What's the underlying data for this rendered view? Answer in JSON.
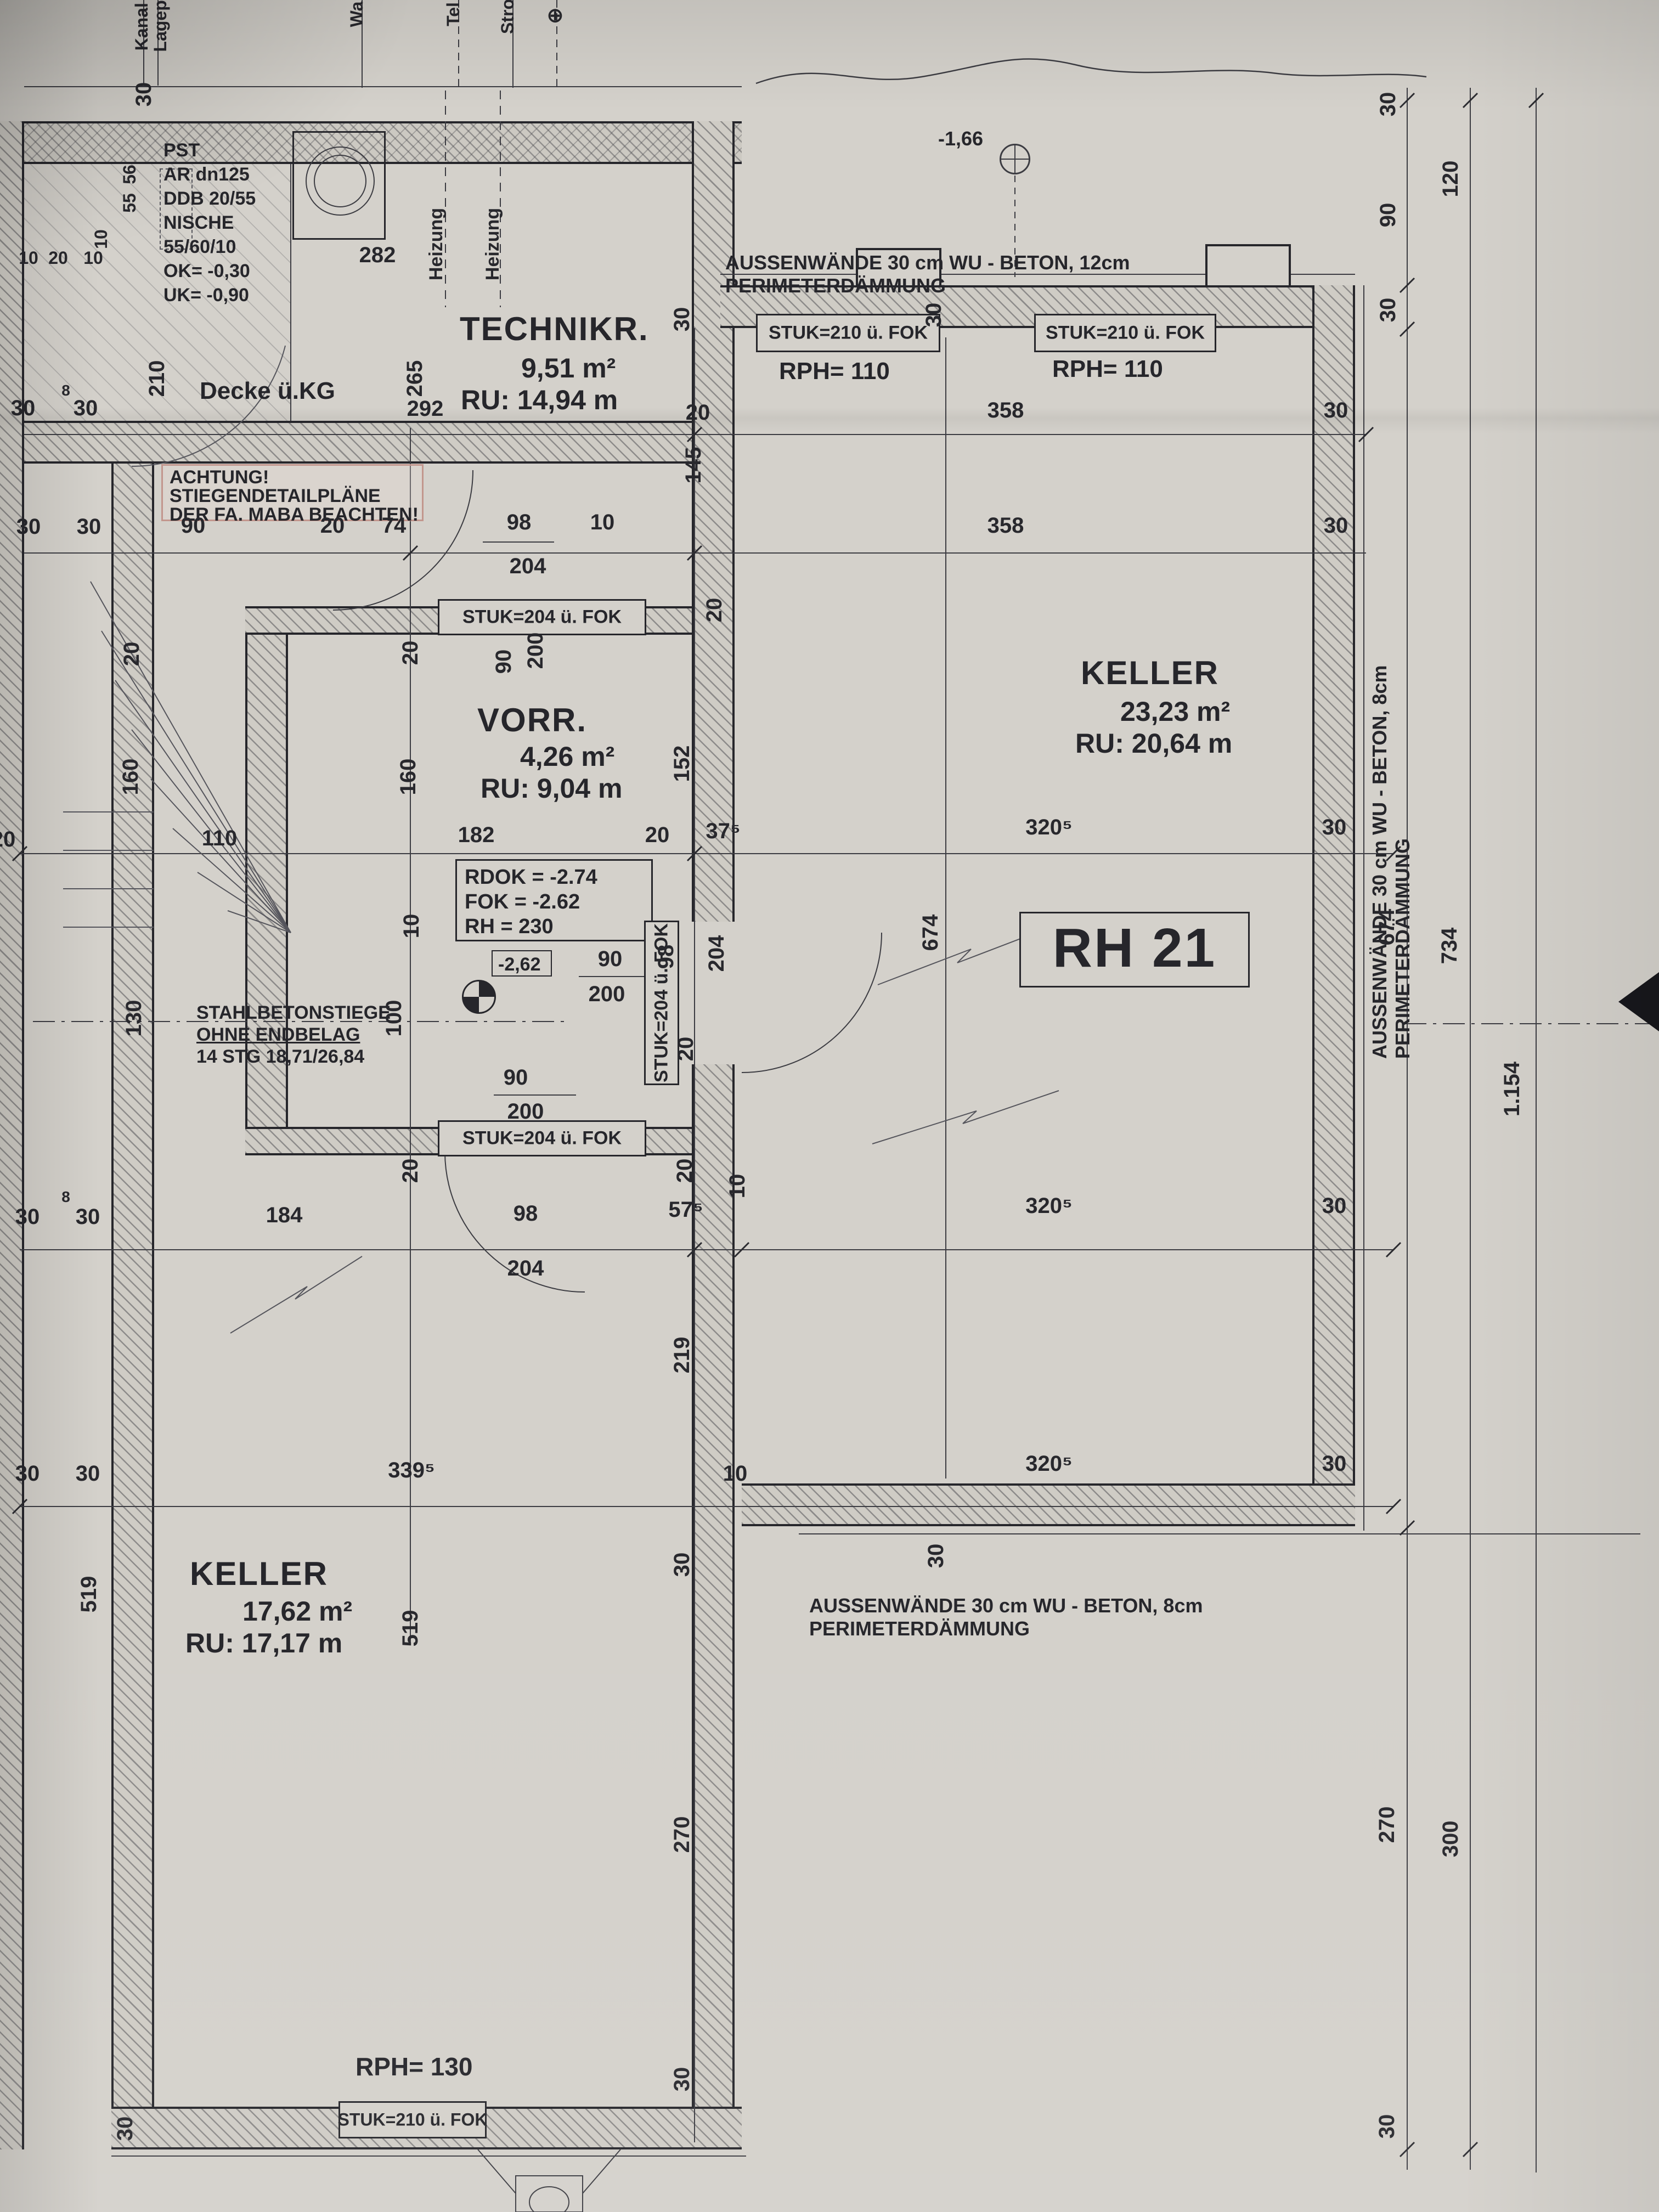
{
  "unit": {
    "label": "RH 21"
  },
  "rooms": {
    "technikraum": {
      "name": "TECHNIKR.",
      "area": "9,51 m²",
      "ru": "RU: 14,94 m"
    },
    "vorraum": {
      "name": "VORR.",
      "area": "4,26 m²",
      "ru": "RU: 9,04 m"
    },
    "keller_main": {
      "name": "KELLER",
      "area": "23,23 m²",
      "ru": "RU: 20,64 m"
    },
    "keller_left": {
      "name": "KELLER",
      "area": "17,62 m²",
      "ru": "RU: 17,17 m"
    }
  },
  "notes": {
    "pst": [
      "PST",
      "AR dn125",
      "DDB 20/55",
      "NISCHE",
      "55/60/10",
      "OK= -0,30",
      "UK= -0,90"
    ],
    "achtung": [
      "ACHTUNG!",
      "STIEGENDETAILPLÄNE",
      "DER FA. MABA BEACHTEN!"
    ],
    "levels": [
      "RDOK = -2.74",
      "FOK = -2.62",
      "RH = 230"
    ],
    "level_tag": "-2,62",
    "ground_level": "-1,66",
    "stairs": [
      "STAHLBETONSTIEGE",
      "OHNE ENDBELAG",
      "14 STG 18,71/26,84"
    ],
    "ceiling": "Decke ü.KG",
    "heating": "Heizung",
    "wall_top_l1": "AUSSENWÄNDE 30 cm WU - BETON, 12cm",
    "wall_top_l2": "PERIMETERDÄMMUNG",
    "wall_bottom_l1": "AUSSENWÄNDE 30 cm WU - BETON, 8cm",
    "wall_bottom_l2": "PERIMETERDÄMMUNG",
    "wall_right_l1": "AUSSENWÄNDE 30 cm WU - BETON, 8cm",
    "wall_right_l2": "PERIMETERDÄMMUNG",
    "stuk210": "STUK=210 ü. FOK",
    "stuk204": "STUK=204 ü. FOK",
    "rph110": "RPH= 110",
    "rph130": "RPH= 130"
  },
  "edge_labels": {
    "kanal": "Kanal st",
    "lageplan": "Lagepla",
    "wasser": "Wa",
    "telefon": "Tel",
    "strom": "Stro",
    "symbol": "⊕"
  },
  "dims": {
    "n8": "8",
    "n10": "10",
    "n20": "20",
    "n30": "30",
    "n37_5": "37⁵",
    "n55": "55",
    "n56": "56",
    "n57_5": "57⁵",
    "n74": "74",
    "n90": "90",
    "n98": "98",
    "n100": "100",
    "n110": "110",
    "n120": "120",
    "n130": "130",
    "n145": "145",
    "n152": "152",
    "n160": "160",
    "n182": "182",
    "n184": "184",
    "n200": "200",
    "n204": "204",
    "n210": "210",
    "n219": "219",
    "n265": "265",
    "n270": "270",
    "n282": "282",
    "n292": "292",
    "n300": "300",
    "n320_5": "320⁵",
    "n339_5": "339⁵",
    "n358": "358",
    "n519": "519",
    "n674": "674",
    "n734": "734",
    "n1154": "1.154"
  }
}
